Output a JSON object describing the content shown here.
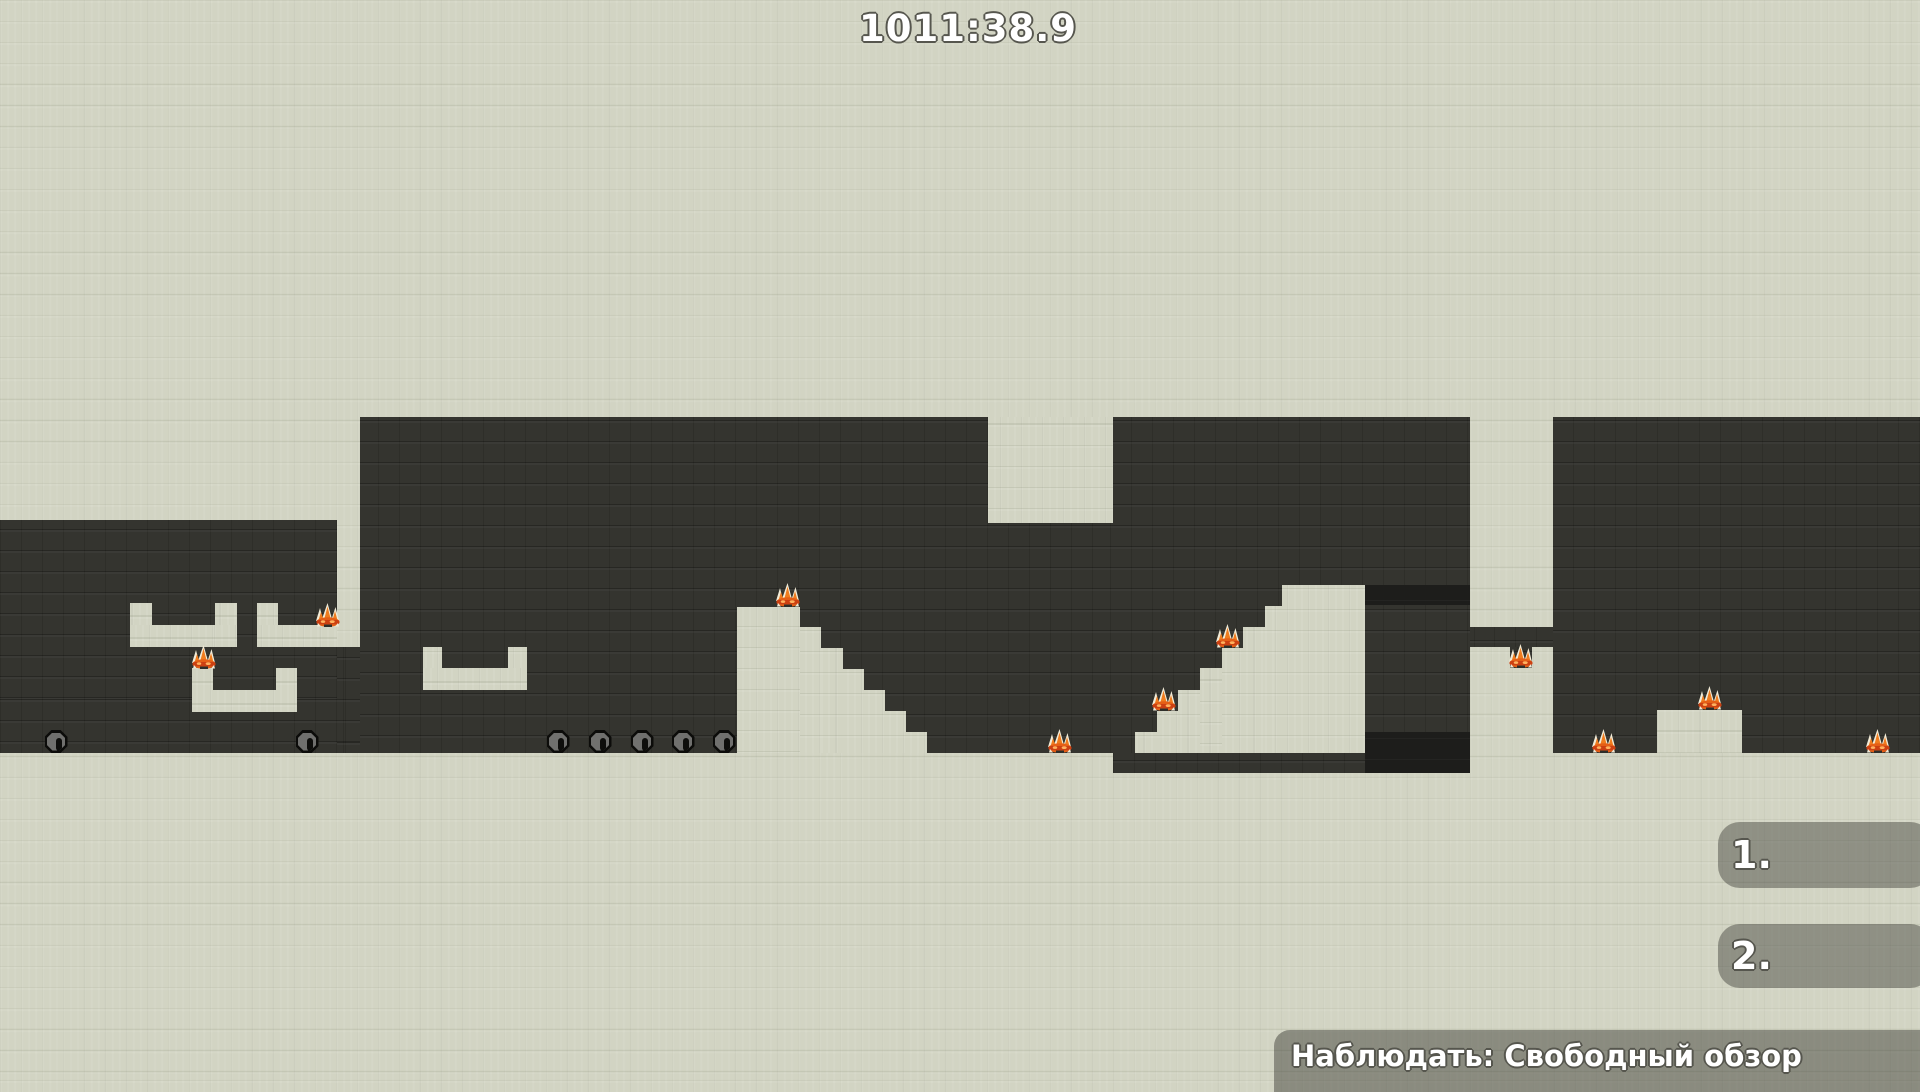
{
  "hud": {
    "timer": "1011:38.9",
    "scoreboard": [
      {
        "rank": "1."
      },
      {
        "rank": "2."
      }
    ],
    "spectate_label": "Наблюдать: Свободный обзор"
  },
  "colors": {
    "background_light": "#d2d4c3",
    "cave_dark": "#34342f",
    "tunnel_black": "#1d1d1b",
    "hud_overlay": "rgba(50,50,45,0.42)",
    "text_outline": "#56564e",
    "flame_orange": "#f07c1e",
    "flame_band_red": "#cc4012",
    "flame_tip_white": "#f2ecd8",
    "plug_gray": "#70706e"
  },
  "scene": {
    "cave_rects": [
      [
        0,
        520,
        337,
        233
      ],
      [
        337,
        647,
        23,
        106
      ],
      [
        360,
        417,
        1110,
        336
      ],
      [
        1553,
        417,
        367,
        336
      ],
      [
        1470,
        627,
        83,
        20
      ],
      [
        1113,
        753,
        252,
        20
      ],
      [
        1510,
        647,
        22,
        21
      ]
    ],
    "dark_tunnels": [
      [
        1365,
        585,
        105,
        20
      ],
      [
        1365,
        732,
        105,
        41
      ]
    ],
    "solid_rects": [
      [
        130,
        603,
        22,
        22
      ],
      [
        215,
        603,
        22,
        22
      ],
      [
        130,
        625,
        107,
        22
      ],
      [
        257,
        603,
        21,
        22
      ],
      [
        257,
        625,
        80,
        22
      ],
      [
        192,
        668,
        21,
        22
      ],
      [
        276,
        668,
        21,
        22
      ],
      [
        192,
        690,
        105,
        22
      ],
      [
        988,
        417,
        125,
        106
      ],
      [
        423,
        647,
        19,
        21
      ],
      [
        508,
        647,
        19,
        21
      ],
      [
        423,
        668,
        104,
        22
      ],
      [
        737,
        607,
        63,
        146
      ],
      [
        800,
        627,
        21,
        126
      ],
      [
        821,
        648,
        22,
        105
      ],
      [
        843,
        669,
        21,
        84
      ],
      [
        864,
        690,
        21,
        63
      ],
      [
        885,
        711,
        21,
        42
      ],
      [
        906,
        732,
        21,
        21
      ],
      [
        1135,
        732,
        22,
        21
      ],
      [
        1157,
        711,
        21,
        42
      ],
      [
        1178,
        690,
        22,
        63
      ],
      [
        1200,
        668,
        22,
        85
      ],
      [
        1222,
        648,
        21,
        105
      ],
      [
        1243,
        627,
        22,
        126
      ],
      [
        1265,
        606,
        17,
        147
      ],
      [
        1282,
        585,
        83,
        168
      ],
      [
        1657,
        710,
        85,
        43
      ]
    ],
    "plugs": [
      [
        56,
        753
      ],
      [
        307,
        753
      ],
      [
        558,
        753
      ],
      [
        600,
        753
      ],
      [
        642,
        753
      ],
      [
        683,
        753
      ],
      [
        724,
        753
      ]
    ],
    "flames": [
      [
        328,
        627
      ],
      [
        204,
        669
      ],
      [
        788,
        607
      ],
      [
        1060,
        753
      ],
      [
        1164,
        711
      ],
      [
        1228,
        648
      ],
      [
        1521,
        668
      ],
      [
        1604,
        753
      ],
      [
        1710,
        710
      ],
      [
        1878,
        753
      ]
    ]
  }
}
